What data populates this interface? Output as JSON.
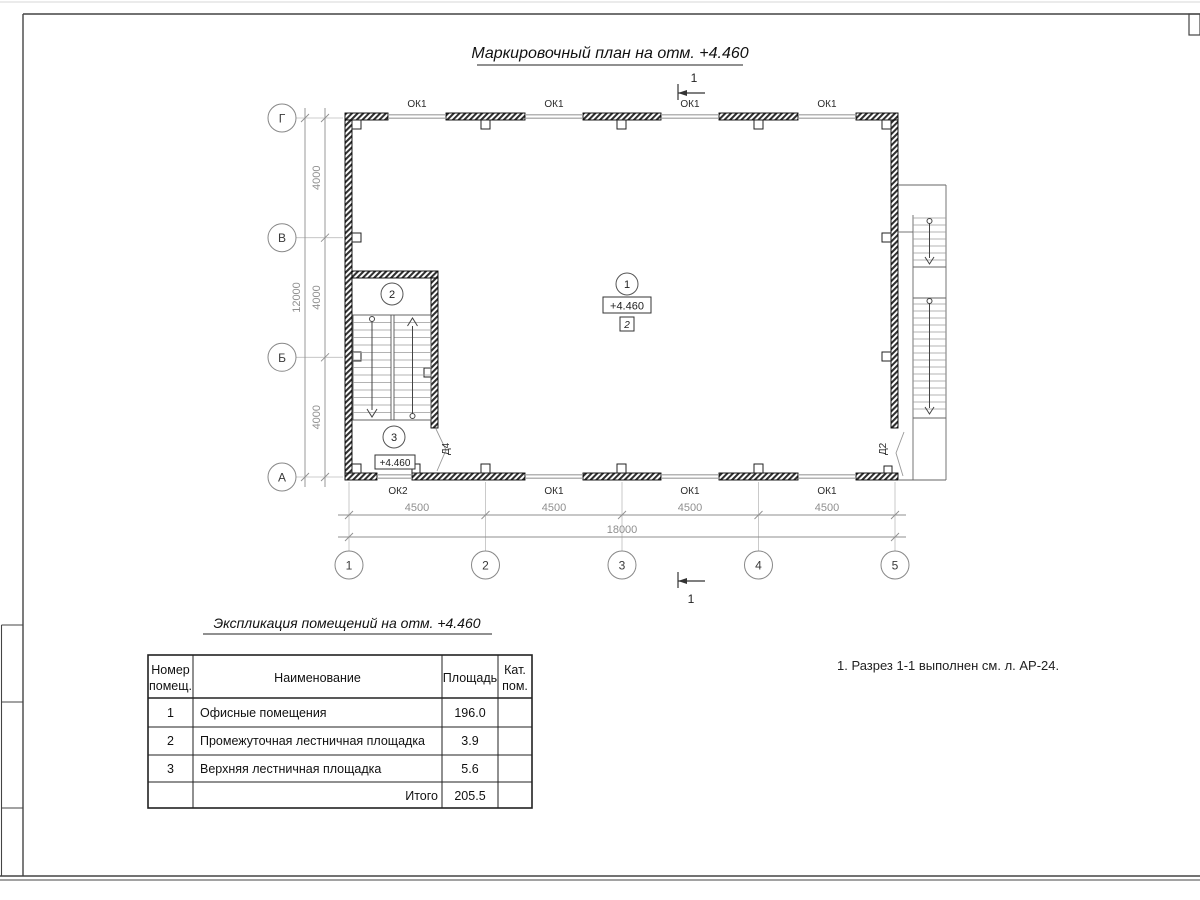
{
  "sheet": {
    "plan_title": "Маркировочный план на отм. +4.460",
    "schedule_title": "Экспликация помещений на отм. +4.460",
    "note": "1. Разрез 1-1 выполнен см. л. АР-24."
  },
  "plan": {
    "elevation_mark": "+4.460",
    "finish_mark": "2",
    "room3_elevation": "+4.460",
    "section_mark_top": "1",
    "section_mark_bottom": "1",
    "rooms": {
      "r1": "1",
      "r2": "2",
      "r3": "3"
    },
    "doors": {
      "d4": "Д4",
      "d2": "Д2"
    },
    "windows_top": [
      "ОК1",
      "ОК1",
      "ОК1",
      "ОК1"
    ],
    "windows_bottom": [
      "ОК2",
      "ОК1",
      "ОК1",
      "ОК1"
    ],
    "axes_letters": [
      "Г",
      "В",
      "Б",
      "А"
    ],
    "axes_numbers": [
      "1",
      "2",
      "3",
      "4",
      "5"
    ],
    "dims": {
      "bottom_segments": [
        "4500",
        "4500",
        "4500",
        "4500"
      ],
      "bottom_total": "18000",
      "left_segments": [
        "4000",
        "4000",
        "4000"
      ],
      "left_total": "12000"
    }
  },
  "schedule": {
    "header": {
      "col1": [
        "Номер",
        "помещ."
      ],
      "col2": "Наименование",
      "col3": "Площадь",
      "col4": [
        "Кат.",
        "пом."
      ]
    },
    "rows": [
      {
        "num": "1",
        "name": "Офисные помещения",
        "area": "196.0"
      },
      {
        "num": "2",
        "name": "Промежуточная лестничная площадка",
        "area": "3.9"
      },
      {
        "num": "3",
        "name": "Верхняя лестничная площадка",
        "area": "5.6"
      }
    ],
    "total_label": "Итого",
    "total_value": "205.5"
  }
}
